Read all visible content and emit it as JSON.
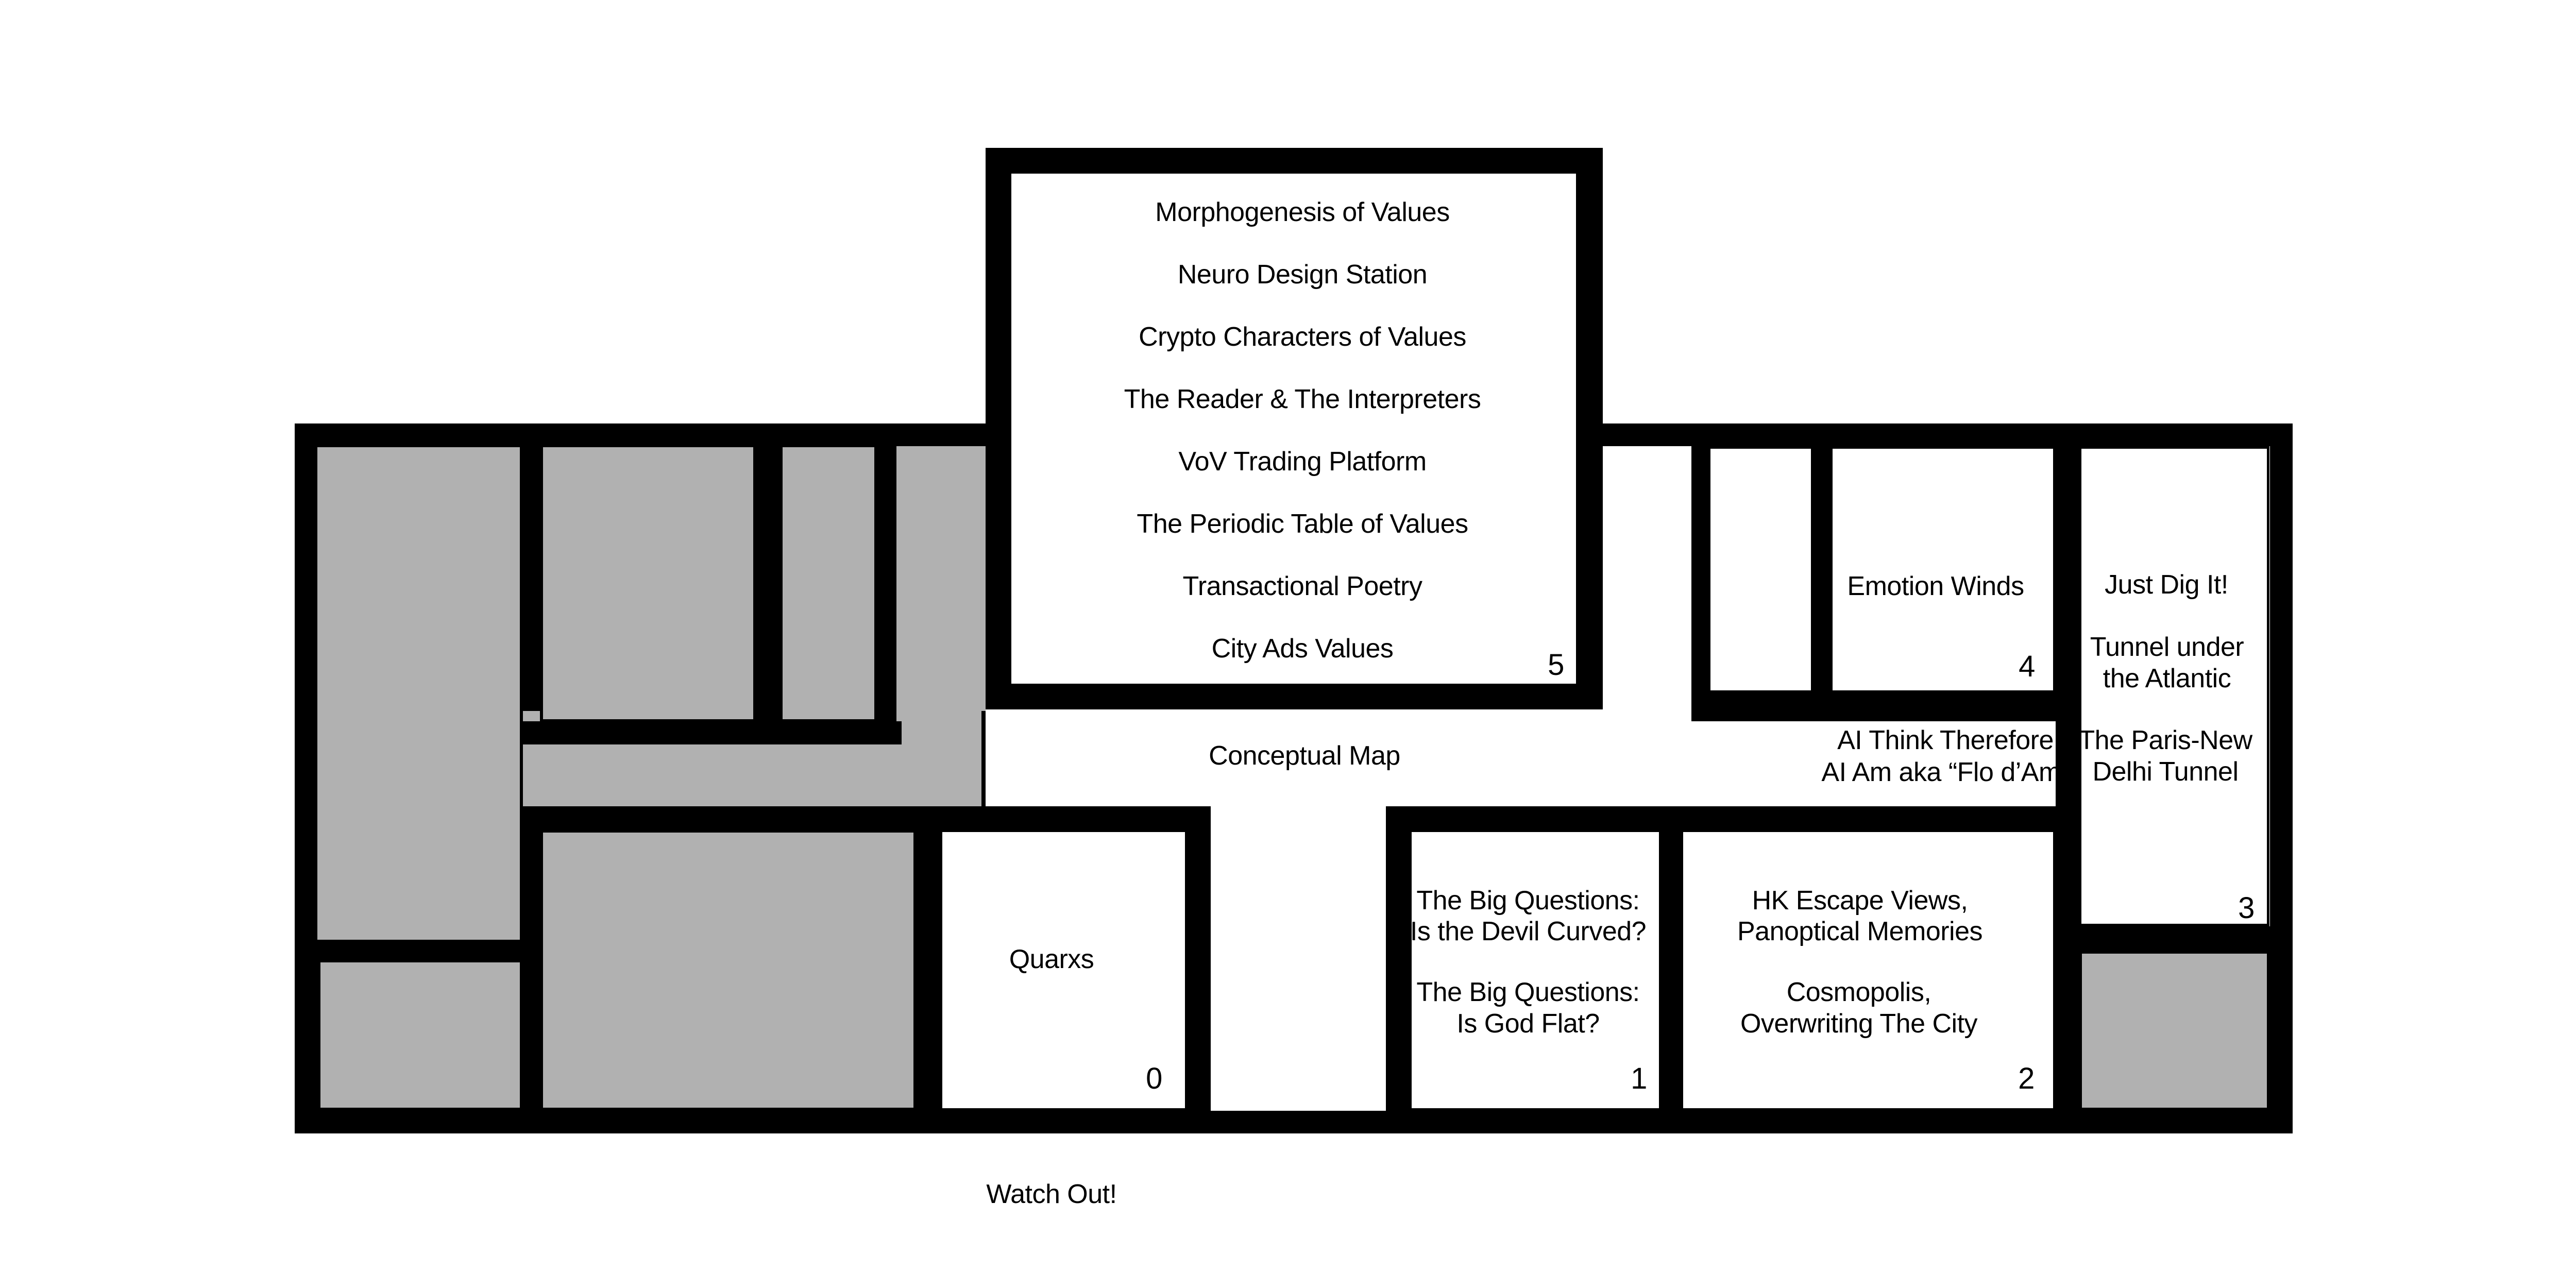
{
  "map": {
    "title": "Conceptual Map",
    "warning": "Watch Out!",
    "corridor_note": {
      "line1": "AI Think Therefore",
      "line2": "AI Am aka “Flo d’Am”"
    },
    "colors": {
      "wall": "#000000",
      "gray_room": "#b1b1b1",
      "background": "#ffffff",
      "text": "#000000"
    },
    "rooms": {
      "room0": {
        "number": "0",
        "label": "Quarxs"
      },
      "room1": {
        "number": "1",
        "lines": [
          "The Big Questions:",
          "Is the Devil Curved?",
          "The Big Questions:",
          "Is God Flat?"
        ]
      },
      "room2": {
        "number": "2",
        "lines": [
          "HK Escape Views,",
          "Panoptical Memories",
          "Cosmopolis,",
          "Overwriting The City"
        ]
      },
      "room3": {
        "number": "3",
        "lines": [
          "Just Dig It!",
          "Tunnel under",
          "the Atlantic",
          "The Paris-New",
          "Delhi Tunnel"
        ]
      },
      "room4": {
        "number": "4",
        "label": "Emotion Winds"
      },
      "room5": {
        "number": "5",
        "exhibits": [
          "Morphogenesis of Values",
          "Neuro Design Station",
          "Crypto Characters of Values",
          "The Reader & The Interpreters",
          "VoV Trading Platform",
          "The Periodic Table of Values",
          "Transactional Poetry",
          "City Ads Values"
        ]
      }
    }
  }
}
